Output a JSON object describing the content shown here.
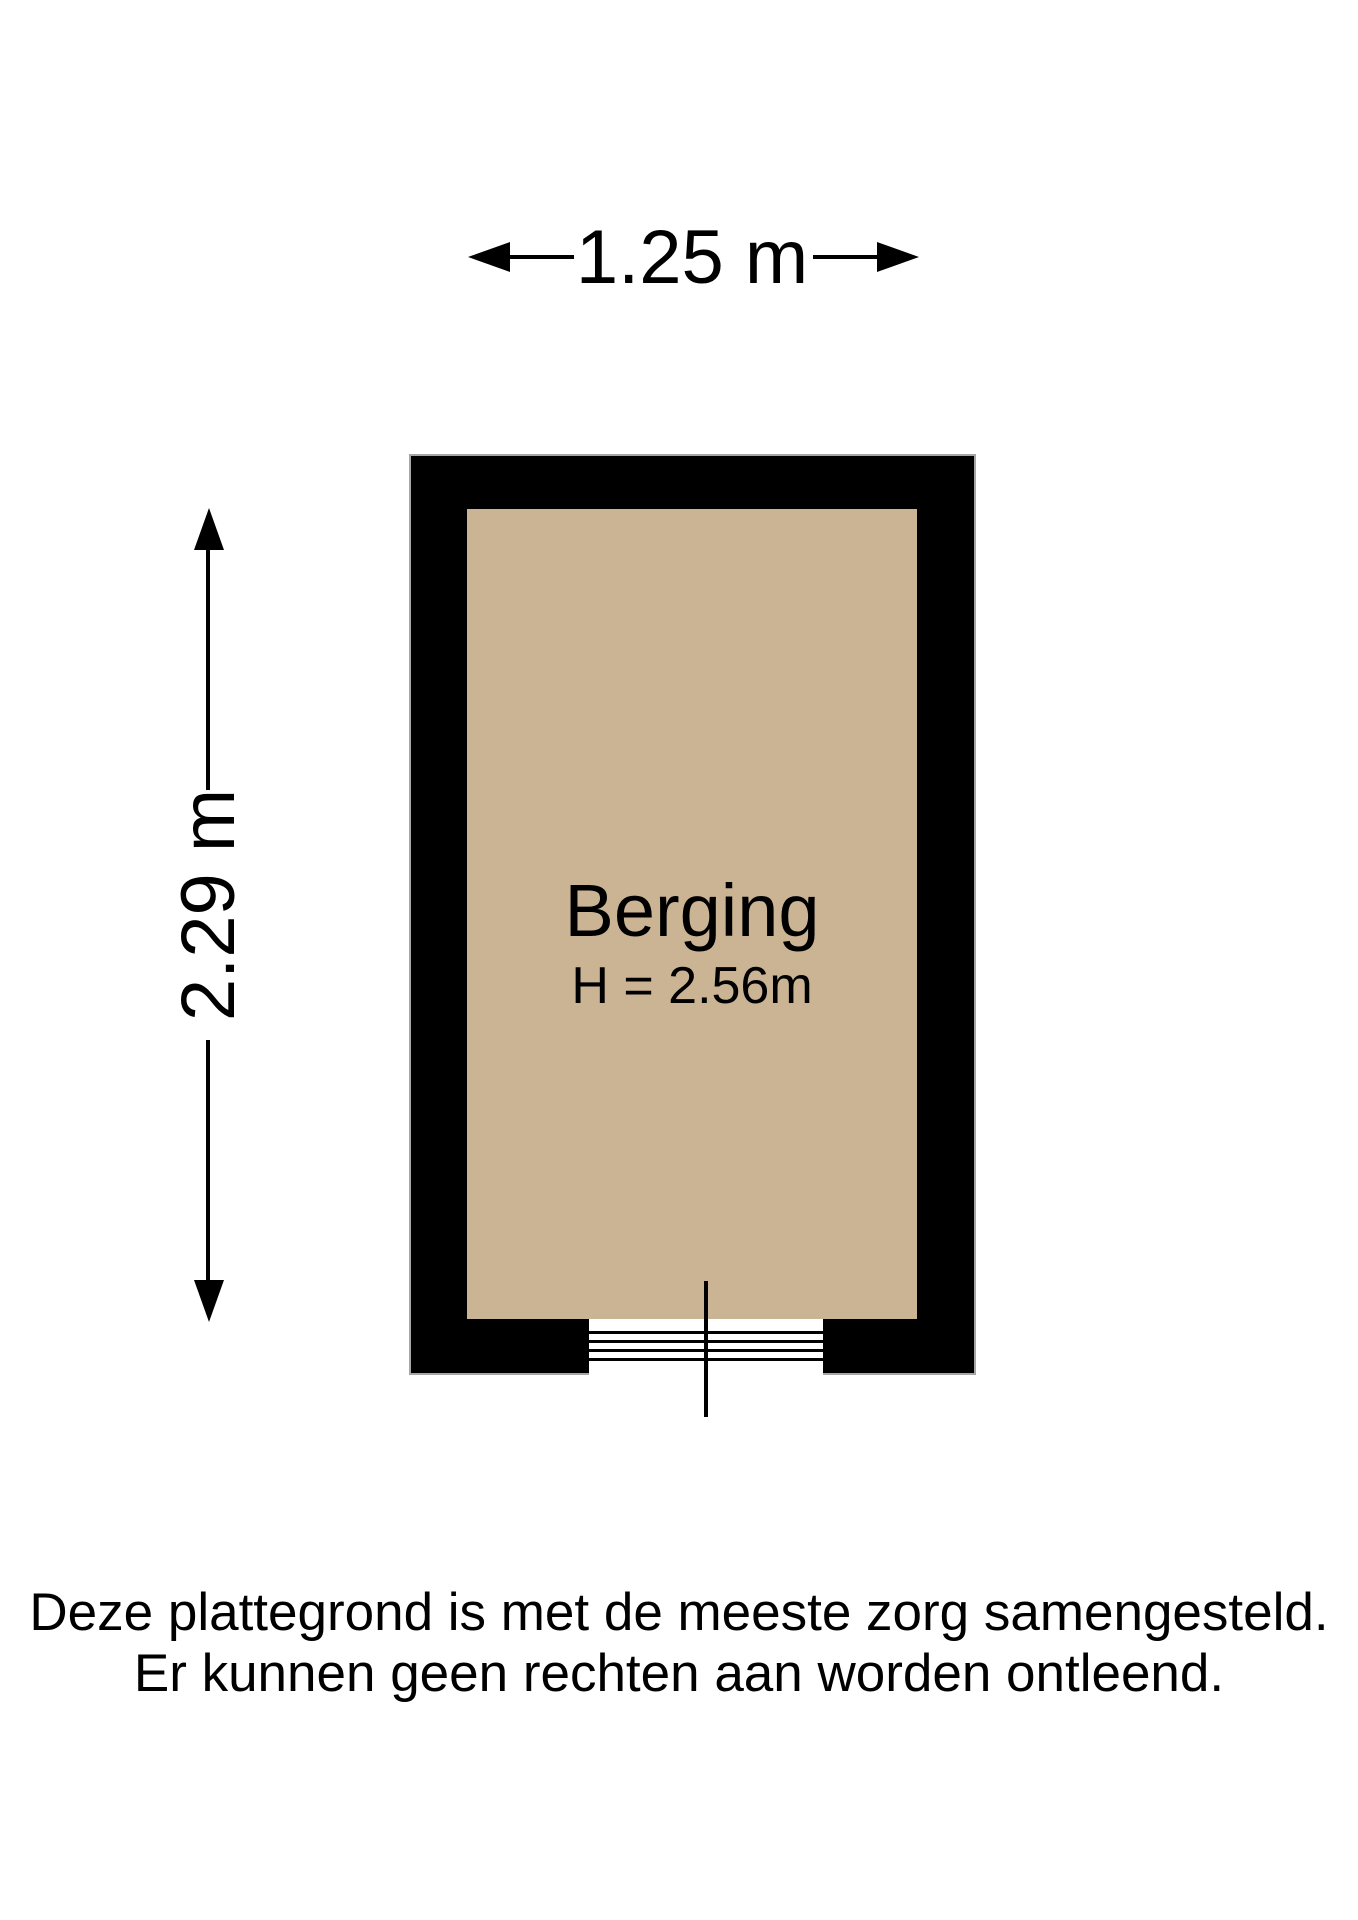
{
  "dimensions": {
    "width_label": "1.25 m",
    "height_label": "2.29 m"
  },
  "room": {
    "name": "Berging",
    "ceiling_height_label": "H = 2.56m"
  },
  "footer": {
    "line1": "Deze plattegrond is met de meeste zorg samengesteld.",
    "line2": "Er kunnen geen rechten aan worden ontleend."
  },
  "colors": {
    "floor": "#CBB494",
    "wall": "#000000",
    "wall_outline": "#A6A6A6"
  }
}
